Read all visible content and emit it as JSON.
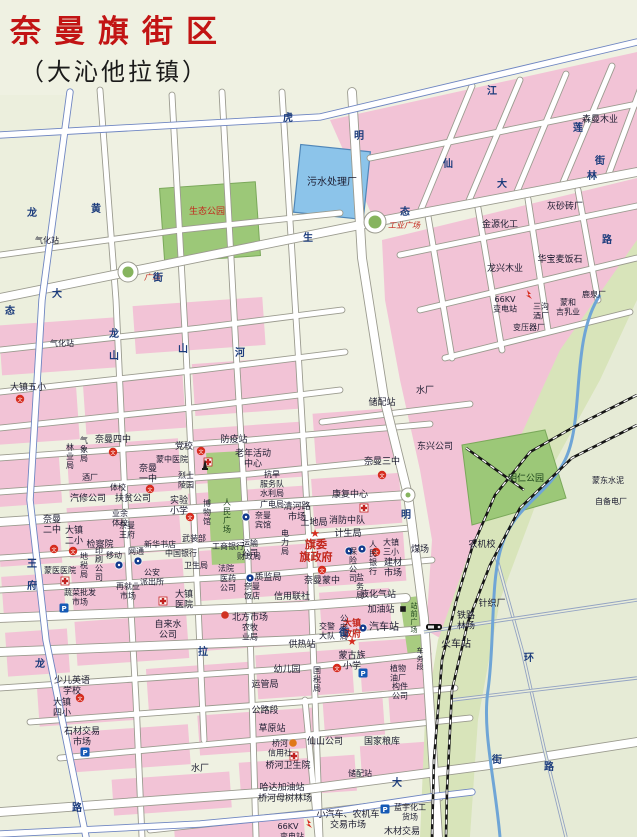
{
  "title": "奈曼旗街区",
  "subtitle": "（大沁他拉镇）",
  "colors": {
    "paper": "#eff1e2",
    "pink": "#f2c3d6",
    "park_green": "#9cc878",
    "corridor_green": "#d8e4ba",
    "rural_green": "#e6ebd6",
    "water": "#8cc4ea",
    "river": "#6fa5d6",
    "road_casing": "#9b9b8f",
    "highway_casing": "#6f86c2",
    "rural_road": "#93a3c2",
    "title_red": "#c21414",
    "label_red": "#c3261c",
    "street_blue": "#1c3c7c"
  },
  "plazas": [
    {
      "t": "工业广场",
      "x": 404,
      "y": 228,
      "c": "r",
      "i": 1,
      "s": 8
    },
    {
      "t": "广场",
      "x": 152,
      "y": 280,
      "c": "r",
      "i": 1,
      "s": 8
    }
  ],
  "labels": [
    {
      "t": "污水处理厂",
      "x": 332,
      "y": 185,
      "s": 10
    },
    {
      "t": "生态公园",
      "x": 207,
      "y": 214,
      "c": "r",
      "s": 9
    },
    {
      "t": "明仁公园",
      "x": 526,
      "y": 481,
      "c": "g",
      "s": 9
    },
    {
      "t": "人民广场",
      "x": 227,
      "y": 505,
      "v": 1,
      "s": 8,
      "c": "g"
    },
    {
      "t": "站前广场",
      "x": 414,
      "y": 608,
      "v": 1,
      "s": 7,
      "c": "g"
    },
    {
      "t": "气化站",
      "x": 47,
      "y": 243,
      "s": 8
    },
    {
      "t": "气化站",
      "x": 62,
      "y": 346,
      "s": 8
    },
    {
      "t": "金源化工",
      "x": 500,
      "y": 227,
      "s": 9
    },
    {
      "t": "灰砂砖厂",
      "x": 565,
      "y": 209,
      "s": 9
    },
    {
      "t": "森曼木业",
      "x": 600,
      "y": 122,
      "s": 9
    },
    {
      "t": "龙兴木业",
      "x": 505,
      "y": 271,
      "s": 9
    },
    {
      "t": "华宝麦饭石",
      "x": 560,
      "y": 262,
      "s": 9
    },
    {
      "l": [
        "66KV",
        "变电站"
      ],
      "x": 505,
      "y": 302,
      "s": 8
    },
    {
      "l": [
        "三沟",
        "酒厂"
      ],
      "x": 541,
      "y": 309,
      "s": 8
    },
    {
      "t": "变压器厂",
      "x": 529,
      "y": 330,
      "s": 8
    },
    {
      "l": [
        "蒙和",
        "吉乳业"
      ],
      "x": 568,
      "y": 305,
      "s": 8
    },
    {
      "t": "鹿泉厂",
      "x": 594,
      "y": 297,
      "s": 8
    },
    {
      "t": "蒙东水泥",
      "x": 608,
      "y": 483,
      "s": 8
    },
    {
      "t": "自备电厂",
      "x": 611,
      "y": 504,
      "s": 8
    },
    {
      "t": "水厂",
      "x": 425,
      "y": 393,
      "s": 9
    },
    {
      "t": "储配站",
      "x": 382,
      "y": 405,
      "s": 9
    },
    {
      "t": "东兴公司",
      "x": 435,
      "y": 449,
      "s": 9
    },
    {
      "t": "奈曼三中",
      "x": 382,
      "y": 464,
      "s": 9
    },
    {
      "t": "康复中心",
      "x": 350,
      "y": 497,
      "s": 9
    },
    {
      "t": "防疫站",
      "x": 234,
      "y": 442,
      "s": 9
    },
    {
      "t": "党校",
      "x": 184,
      "y": 449,
      "s": 9
    },
    {
      "t": "蒙中医院",
      "x": 172,
      "y": 462,
      "s": 8
    },
    {
      "l": [
        "老年活动",
        "中心"
      ],
      "x": 253,
      "y": 456,
      "s": 9
    },
    {
      "l": [
        "烈士",
        "陵园"
      ],
      "x": 186,
      "y": 478,
      "s": 8
    },
    {
      "l": [
        "实验",
        "小学"
      ],
      "x": 179,
      "y": 503,
      "s": 9
    },
    {
      "t": "博物馆",
      "x": 207,
      "y": 506,
      "v": 1,
      "s": 8
    },
    {
      "l": [
        "奈曼",
        "一中"
      ],
      "x": 148,
      "y": 471,
      "s": 9
    },
    {
      "l": [
        "抗旱",
        "服务队"
      ],
      "x": 272,
      "y": 477,
      "s": 8
    },
    {
      "t": "水利局",
      "x": 272,
      "y": 496,
      "s": 8
    },
    {
      "t": "广电局",
      "x": 272,
      "y": 507,
      "s": 8
    },
    {
      "l": [
        "清河路",
        "市场"
      ],
      "x": 297,
      "y": 509,
      "s": 9
    },
    {
      "l": [
        "奈曼",
        "宾馆"
      ],
      "x": 263,
      "y": 518,
      "s": 8
    },
    {
      "t": "土地局",
      "x": 314,
      "y": 525,
      "s": 9
    },
    {
      "t": "消防中队",
      "x": 347,
      "y": 523,
      "s": 9
    },
    {
      "t": "计生局",
      "x": 348,
      "y": 536,
      "s": 9
    },
    {
      "l": [
        "旗委",
        "旗政府"
      ],
      "x": 316,
      "y": 548,
      "c": "r",
      "b": 1,
      "s": 11
    },
    {
      "t": "电力局",
      "x": 285,
      "y": 536,
      "v": 1,
      "s": 8
    },
    {
      "l": [
        "运输",
        "公司"
      ],
      "x": 250,
      "y": 546,
      "s": 8
    },
    {
      "t": "奈曼蒙中",
      "x": 322,
      "y": 583,
      "s": 9
    },
    {
      "t": "保险公司",
      "x": 353,
      "y": 554,
      "v": 1,
      "s": 8
    },
    {
      "t": "人民银行",
      "x": 373,
      "y": 547,
      "v": 1,
      "s": 8
    },
    {
      "l": [
        "大镇",
        "三小"
      ],
      "x": 391,
      "y": 545,
      "s": 8
    },
    {
      "t": "煤场",
      "x": 420,
      "y": 552,
      "s": 9
    },
    {
      "t": "农机校",
      "x": 482,
      "y": 547,
      "s": 9
    },
    {
      "l": [
        "建材",
        "市场"
      ],
      "x": 393,
      "y": 565,
      "s": 9
    },
    {
      "t": "盐务局",
      "x": 360,
      "y": 580,
      "v": 1,
      "s": 8
    },
    {
      "t": "液化气站",
      "x": 378,
      "y": 597,
      "s": 9
    },
    {
      "t": "加油站",
      "x": 381,
      "y": 612,
      "s": 9
    },
    {
      "t": "汽车站",
      "x": 384,
      "y": 630,
      "s": 10
    },
    {
      "l": [
        "大镇",
        "政府"
      ],
      "x": 352,
      "y": 626,
      "c": "r",
      "b": 1,
      "s": 9
    },
    {
      "t": "公安局",
      "x": 344,
      "y": 621,
      "v": 1,
      "s": 8
    },
    {
      "l": [
        "交警",
        "大队"
      ],
      "x": 327,
      "y": 629,
      "s": 8
    },
    {
      "t": "质监局",
      "x": 268,
      "y": 580,
      "s": 9
    },
    {
      "t": "信用联社",
      "x": 292,
      "y": 599,
      "s": 9
    },
    {
      "t": "北方市场",
      "x": 250,
      "y": 620,
      "s": 9
    },
    {
      "l": [
        "医药",
        "公司"
      ],
      "x": 228,
      "y": 581,
      "s": 8
    },
    {
      "l": [
        "奈曼",
        "饭店"
      ],
      "x": 252,
      "y": 589,
      "s": 8
    },
    {
      "l": [
        "大镇",
        "医院"
      ],
      "x": 184,
      "y": 597,
      "s": 9
    },
    {
      "l": [
        "自来水",
        "公司"
      ],
      "x": 168,
      "y": 627,
      "s": 9
    },
    {
      "l": [
        "农牧",
        "业局"
      ],
      "x": 250,
      "y": 630,
      "s": 8
    },
    {
      "t": "供热站",
      "x": 302,
      "y": 647,
      "s": 9
    },
    {
      "t": "幼儿园",
      "x": 287,
      "y": 672,
      "s": 9
    },
    {
      "t": "国税局",
      "x": 317,
      "y": 673,
      "v": 1,
      "s": 8
    },
    {
      "l": [
        "蒙古族",
        "小学"
      ],
      "x": 352,
      "y": 658,
      "s": 9
    },
    {
      "t": "运管局",
      "x": 265,
      "y": 687,
      "s": 9
    },
    {
      "t": "公路段",
      "x": 265,
      "y": 713,
      "s": 9
    },
    {
      "t": "草原站",
      "x": 272,
      "y": 731,
      "s": 9
    },
    {
      "l": [
        "桥河",
        "信用社"
      ],
      "x": 280,
      "y": 746,
      "s": 8
    },
    {
      "t": "仙山公司",
      "x": 325,
      "y": 744,
      "s": 9
    },
    {
      "t": "桥河卫生院",
      "x": 288,
      "y": 768,
      "s": 9
    },
    {
      "t": "哈达加油站",
      "x": 282,
      "y": 790,
      "s": 9
    },
    {
      "t": "桥河母树林场",
      "x": 285,
      "y": 801,
      "s": 9
    },
    {
      "t": "水厂",
      "x": 200,
      "y": 771,
      "s": 9
    },
    {
      "t": "国家粮库",
      "x": 382,
      "y": 744,
      "s": 9
    },
    {
      "t": "储配站",
      "x": 360,
      "y": 776,
      "s": 8
    },
    {
      "l": [
        "小汽车、农机车",
        "交易市场"
      ],
      "x": 348,
      "y": 817,
      "s": 9
    },
    {
      "l": [
        "蓝宇化工",
        "货场"
      ],
      "x": 410,
      "y": 810,
      "s": 8
    },
    {
      "t": "木材交易",
      "x": 402,
      "y": 834,
      "s": 9
    },
    {
      "t": "66KV",
      "x": 288,
      "y": 829,
      "s": 8
    },
    {
      "t": "变电站",
      "x": 292,
      "y": 839,
      "s": 8
    },
    {
      "t": "针织厂",
      "x": 492,
      "y": 606,
      "s": 9
    },
    {
      "l": [
        "铁路",
        "林场"
      ],
      "x": 466,
      "y": 618,
      "s": 9
    },
    {
      "t": "火车站",
      "x": 456,
      "y": 647,
      "s": 10
    },
    {
      "t": "车务段",
      "x": 420,
      "y": 653,
      "v": 1,
      "s": 7
    },
    {
      "l": [
        "植物",
        "油厂"
      ],
      "x": 398,
      "y": 671,
      "s": 8
    },
    {
      "l": [
        "构件",
        "公司"
      ],
      "x": 400,
      "y": 689,
      "s": 8
    },
    {
      "t": "新华书店",
      "x": 160,
      "y": 547,
      "s": 8
    },
    {
      "t": "武装部",
      "x": 194,
      "y": 541,
      "s": 8
    },
    {
      "t": "中国银行",
      "x": 181,
      "y": 556,
      "s": 8
    },
    {
      "t": "工商银行",
      "x": 228,
      "y": 549,
      "s": 8
    },
    {
      "t": "财政局",
      "x": 249,
      "y": 559,
      "s": 8
    },
    {
      "t": "法院",
      "x": 226,
      "y": 571,
      "s": 8
    },
    {
      "t": "卫生局",
      "x": 196,
      "y": 568,
      "s": 8
    },
    {
      "t": "检察院",
      "x": 100,
      "y": 547,
      "s": 9
    },
    {
      "l": [
        "奈曼",
        "二中"
      ],
      "x": 52,
      "y": 522,
      "s": 9
    },
    {
      "l": [
        "大镇",
        "二小"
      ],
      "x": 74,
      "y": 533,
      "s": 9
    },
    {
      "l": [
        "奈曼",
        "王府"
      ],
      "x": 127,
      "y": 528,
      "s": 8
    },
    {
      "l": [
        "业余",
        "体校"
      ],
      "x": 120,
      "y": 516,
      "s": 8
    },
    {
      "t": "扶贫公司",
      "x": 133,
      "y": 501,
      "s": 9
    },
    {
      "t": "汽修公司",
      "x": 88,
      "y": 501,
      "s": 9
    },
    {
      "t": "体校",
      "x": 118,
      "y": 490,
      "s": 8
    },
    {
      "t": "奈曼四中",
      "x": 113,
      "y": 442,
      "s": 9
    },
    {
      "t": "林业局",
      "x": 70,
      "y": 450,
      "v": 1,
      "s": 8
    },
    {
      "t": "气象局",
      "x": 84,
      "y": 443,
      "v": 1,
      "s": 8
    },
    {
      "t": "酒厂",
      "x": 90,
      "y": 480,
      "s": 8
    },
    {
      "t": "大镇五小",
      "x": 28,
      "y": 390,
      "s": 9
    },
    {
      "t": "蒙医医院",
      "x": 60,
      "y": 573,
      "s": 8
    },
    {
      "t": "地税局",
      "x": 84,
      "y": 559,
      "v": 1,
      "s": 8
    },
    {
      "t": "印刷公司",
      "x": 99,
      "y": 553,
      "v": 1,
      "s": 8
    },
    {
      "t": "移动",
      "x": 114,
      "y": 558,
      "s": 8
    },
    {
      "t": "网通",
      "x": 136,
      "y": 554,
      "s": 8
    },
    {
      "l": [
        "公安",
        "派出所"
      ],
      "x": 152,
      "y": 575,
      "s": 8
    },
    {
      "l": [
        "再就业",
        "市场"
      ],
      "x": 128,
      "y": 589,
      "s": 8
    },
    {
      "l": [
        "蔬菜批发",
        "市场"
      ],
      "x": 80,
      "y": 595,
      "s": 8
    },
    {
      "l": [
        "大镇",
        "四小"
      ],
      "x": 62,
      "y": 705,
      "s": 9
    },
    {
      "l": [
        "少儿英语",
        "学校"
      ],
      "x": 72,
      "y": 683,
      "s": 9
    },
    {
      "l": [
        "石材交易",
        "市场"
      ],
      "x": 82,
      "y": 734,
      "s": 9
    }
  ],
  "street_names": [
    {
      "t": "虎",
      "x": 288,
      "y": 121
    },
    {
      "t": "龙",
      "x": 32,
      "y": 216
    },
    {
      "t": "黄",
      "x": 96,
      "y": 212
    },
    {
      "t": "大",
      "x": 57,
      "y": 297
    },
    {
      "t": "街",
      "x": 158,
      "y": 281
    },
    {
      "t": "龙",
      "x": 114,
      "y": 337
    },
    {
      "t": "山",
      "x": 114,
      "y": 359
    },
    {
      "t": "态",
      "x": 10,
      "y": 314
    },
    {
      "t": "河",
      "x": 240,
      "y": 356
    },
    {
      "t": "生",
      "x": 308,
      "y": 241
    },
    {
      "t": "态",
      "x": 405,
      "y": 215
    },
    {
      "t": "明",
      "x": 359,
      "y": 139
    },
    {
      "t": "明",
      "x": 406,
      "y": 518
    },
    {
      "t": "大",
      "x": 502,
      "y": 187
    },
    {
      "t": "街",
      "x": 600,
      "y": 164
    },
    {
      "t": "江",
      "x": 492,
      "y": 94
    },
    {
      "t": "莲",
      "x": 578,
      "y": 131
    },
    {
      "t": "林",
      "x": 592,
      "y": 179
    },
    {
      "t": "路",
      "x": 607,
      "y": 243
    },
    {
      "t": "仙",
      "x": 448,
      "y": 167
    },
    {
      "t": "环",
      "x": 529,
      "y": 661
    },
    {
      "t": "路",
      "x": 549,
      "y": 770
    },
    {
      "t": "大",
      "x": 397,
      "y": 786
    },
    {
      "t": "街",
      "x": 497,
      "y": 763
    },
    {
      "t": "拉",
      "x": 203,
      "y": 655
    },
    {
      "t": "王",
      "x": 32,
      "y": 567
    },
    {
      "t": "府",
      "x": 32,
      "y": 589
    },
    {
      "t": "山",
      "x": 183,
      "y": 352
    },
    {
      "t": "龙",
      "x": 40,
      "y": 667
    },
    {
      "t": "路",
      "x": 77,
      "y": 811
    },
    {
      "t": "街",
      "x": 344,
      "y": 636
    }
  ],
  "icons": [
    {
      "k": "school",
      "x": 382,
      "y": 475
    },
    {
      "k": "school",
      "x": 113,
      "y": 452
    },
    {
      "k": "school",
      "x": 20,
      "y": 399
    },
    {
      "k": "school",
      "x": 150,
      "y": 489
    },
    {
      "k": "school",
      "x": 54,
      "y": 549
    },
    {
      "k": "school",
      "x": 73,
      "y": 551
    },
    {
      "k": "school",
      "x": 190,
      "y": 517
    },
    {
      "k": "school",
      "x": 322,
      "y": 570
    },
    {
      "k": "school",
      "x": 376,
      "y": 552
    },
    {
      "k": "school",
      "x": 337,
      "y": 668
    },
    {
      "k": "school",
      "x": 80,
      "y": 698
    },
    {
      "k": "school",
      "x": 201,
      "y": 451
    },
    {
      "k": "cross",
      "x": 364,
      "y": 508
    },
    {
      "k": "cross",
      "x": 208,
      "y": 462
    },
    {
      "k": "cross",
      "x": 163,
      "y": 601
    },
    {
      "k": "cross",
      "x": 65,
      "y": 581
    },
    {
      "k": "cross",
      "x": 294,
      "y": 756
    },
    {
      "k": "star",
      "x": 315,
      "y": 533
    },
    {
      "k": "star",
      "x": 352,
      "y": 641
    },
    {
      "k": "parking",
      "x": 363,
      "y": 673
    },
    {
      "k": "parking",
      "x": 64,
      "y": 608
    },
    {
      "k": "parking",
      "x": 85,
      "y": 752
    },
    {
      "k": "parking",
      "x": 385,
      "y": 809
    },
    {
      "k": "navy",
      "x": 349,
      "y": 551
    },
    {
      "k": "navy",
      "x": 362,
      "y": 549
    },
    {
      "k": "navy",
      "x": 246,
      "y": 517
    },
    {
      "k": "navy",
      "x": 250,
      "y": 578
    },
    {
      "k": "navy",
      "x": 119,
      "y": 565
    },
    {
      "k": "navy",
      "x": 138,
      "y": 561
    },
    {
      "k": "navy",
      "x": 363,
      "y": 628
    },
    {
      "k": "reddot",
      "x": 225,
      "y": 615
    },
    {
      "k": "orangedot",
      "x": 293,
      "y": 743
    },
    {
      "k": "blacksq",
      "x": 403,
      "y": 609
    },
    {
      "k": "bolt",
      "x": 528,
      "y": 296
    },
    {
      "k": "bolt",
      "x": 308,
      "y": 825
    },
    {
      "k": "train",
      "x": 434,
      "y": 627
    },
    {
      "k": "monument",
      "x": 205,
      "y": 469
    }
  ],
  "roundabouts": [
    {
      "x": 128,
      "y": 272,
      "r": 10
    },
    {
      "x": 375,
      "y": 222,
      "r": 11
    },
    {
      "x": 408,
      "y": 495,
      "r": 7
    }
  ]
}
